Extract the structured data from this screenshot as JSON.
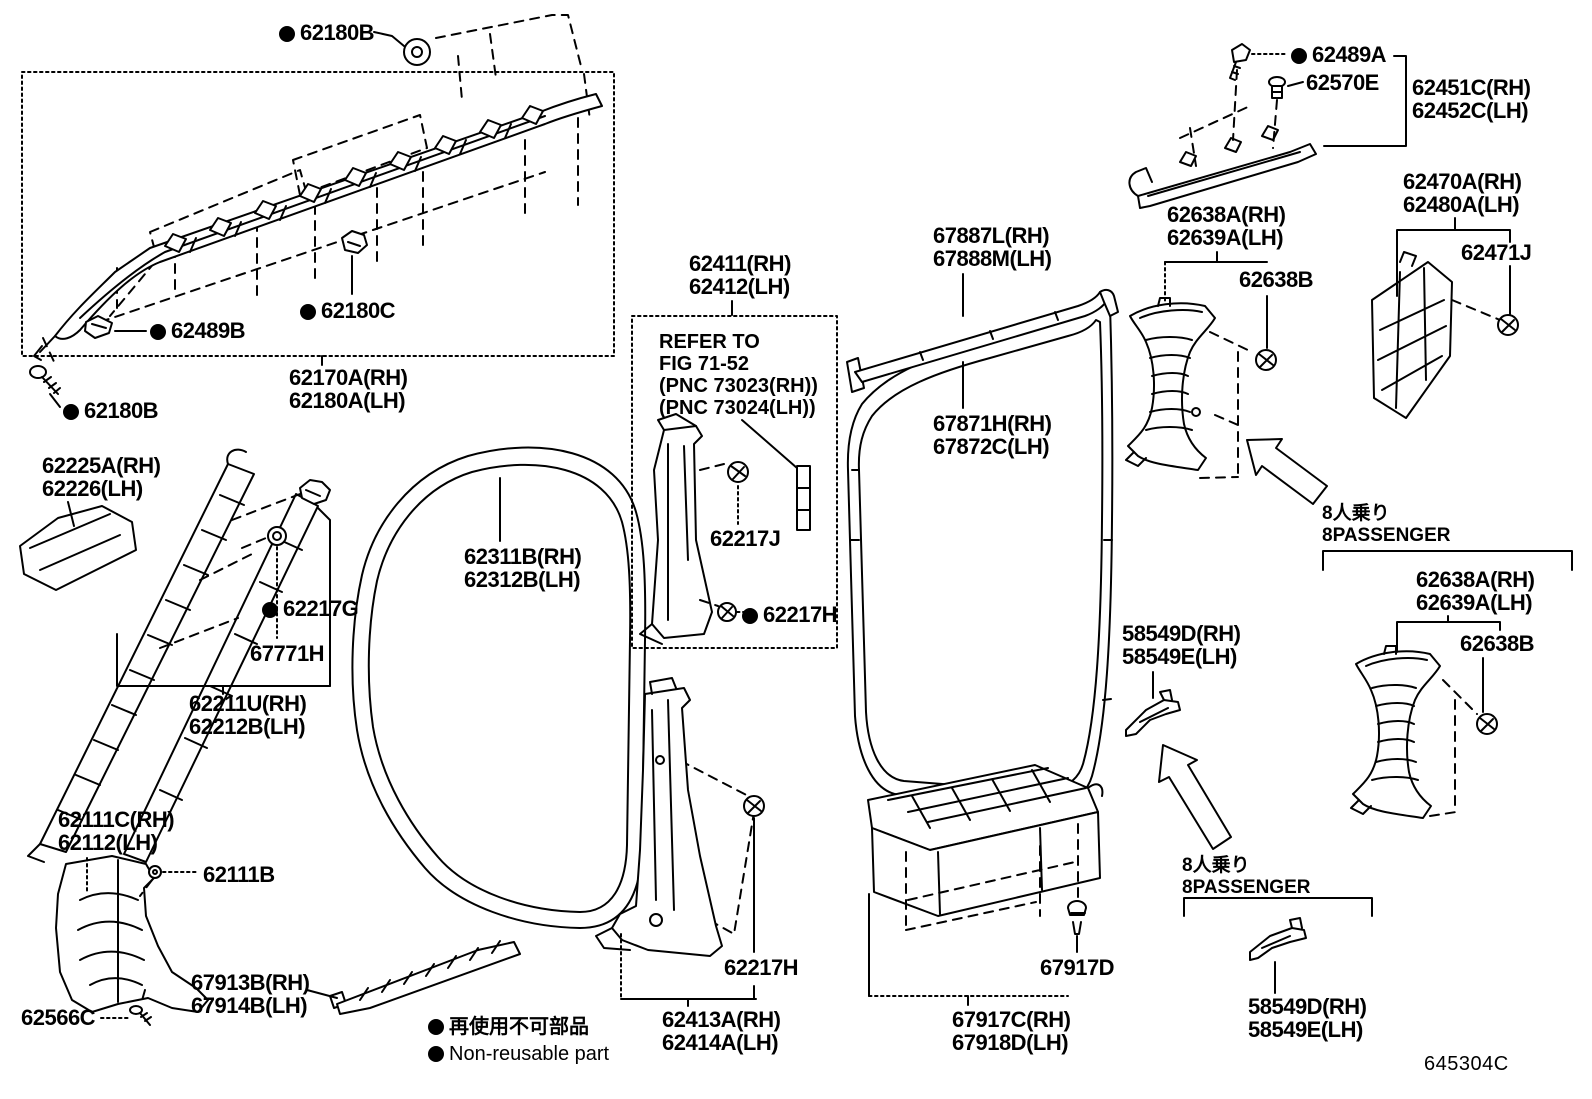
{
  "figure_code": "645304C",
  "legend": {
    "ja": "再使用不可部品",
    "en": "Non-reusable part"
  },
  "notes": {
    "refer": [
      "REFER TO",
      "FIG 71-52",
      "(PNC 73023(RH))",
      "(PNC 73024(LH))"
    ],
    "passenger_ja": "8人乗り",
    "passenger_en": "8PASSENGER"
  },
  "parts": {
    "p62180b": {
      "num": "62180B"
    },
    "p62489b": {
      "num": "62489B"
    },
    "p62180c": {
      "num": "62180C"
    },
    "p62170a": {
      "rh": "62170A(RH)",
      "lh": "62180A(LH)"
    },
    "p62225a": {
      "rh": "62225A(RH)",
      "lh": "62226(LH)"
    },
    "p62217g": {
      "num": "62217G"
    },
    "p67771h": {
      "num": "67771H"
    },
    "p62211u": {
      "rh": "62211U(RH)",
      "lh": "62212B(LH)"
    },
    "p62311b": {
      "rh": "62311B(RH)",
      "lh": "62312B(LH)"
    },
    "p62111c": {
      "rh": "62111C(RH)",
      "lh": "62112(LH)"
    },
    "p62111b": {
      "num": "62111B"
    },
    "p62566c": {
      "num": "62566C"
    },
    "p67913b": {
      "rh": "67913B(RH)",
      "lh": "67914B(LH)"
    },
    "p62411": {
      "rh": "62411(RH)",
      "lh": "62412(LH)"
    },
    "p62217j": {
      "num": "62217J"
    },
    "p62217h": {
      "num": "62217H"
    },
    "p62413a": {
      "rh": "62413A(RH)",
      "lh": "62414A(LH)"
    },
    "p67887l": {
      "rh": "67887L(RH)",
      "lh": "67888M(LH)"
    },
    "p67871h": {
      "rh": "67871H(RH)",
      "lh": "67872C(LH)"
    },
    "p67917c": {
      "rh": "67917C(RH)",
      "lh": "67918D(LH)"
    },
    "p67917d": {
      "num": "67917D"
    },
    "p62489a": {
      "num": "62489A"
    },
    "p62570e": {
      "num": "62570E"
    },
    "p62451c": {
      "rh": "62451C(RH)",
      "lh": "62452C(LH)"
    },
    "p62470a": {
      "rh": "62470A(RH)",
      "lh": "62480A(LH)"
    },
    "p62471j": {
      "num": "62471J"
    },
    "p62638a": {
      "rh": "62638A(RH)",
      "lh": "62639A(LH)"
    },
    "p62638b": {
      "num": "62638B"
    },
    "p58549d": {
      "rh": "58549D(RH)",
      "lh": "58549E(LH)"
    }
  }
}
